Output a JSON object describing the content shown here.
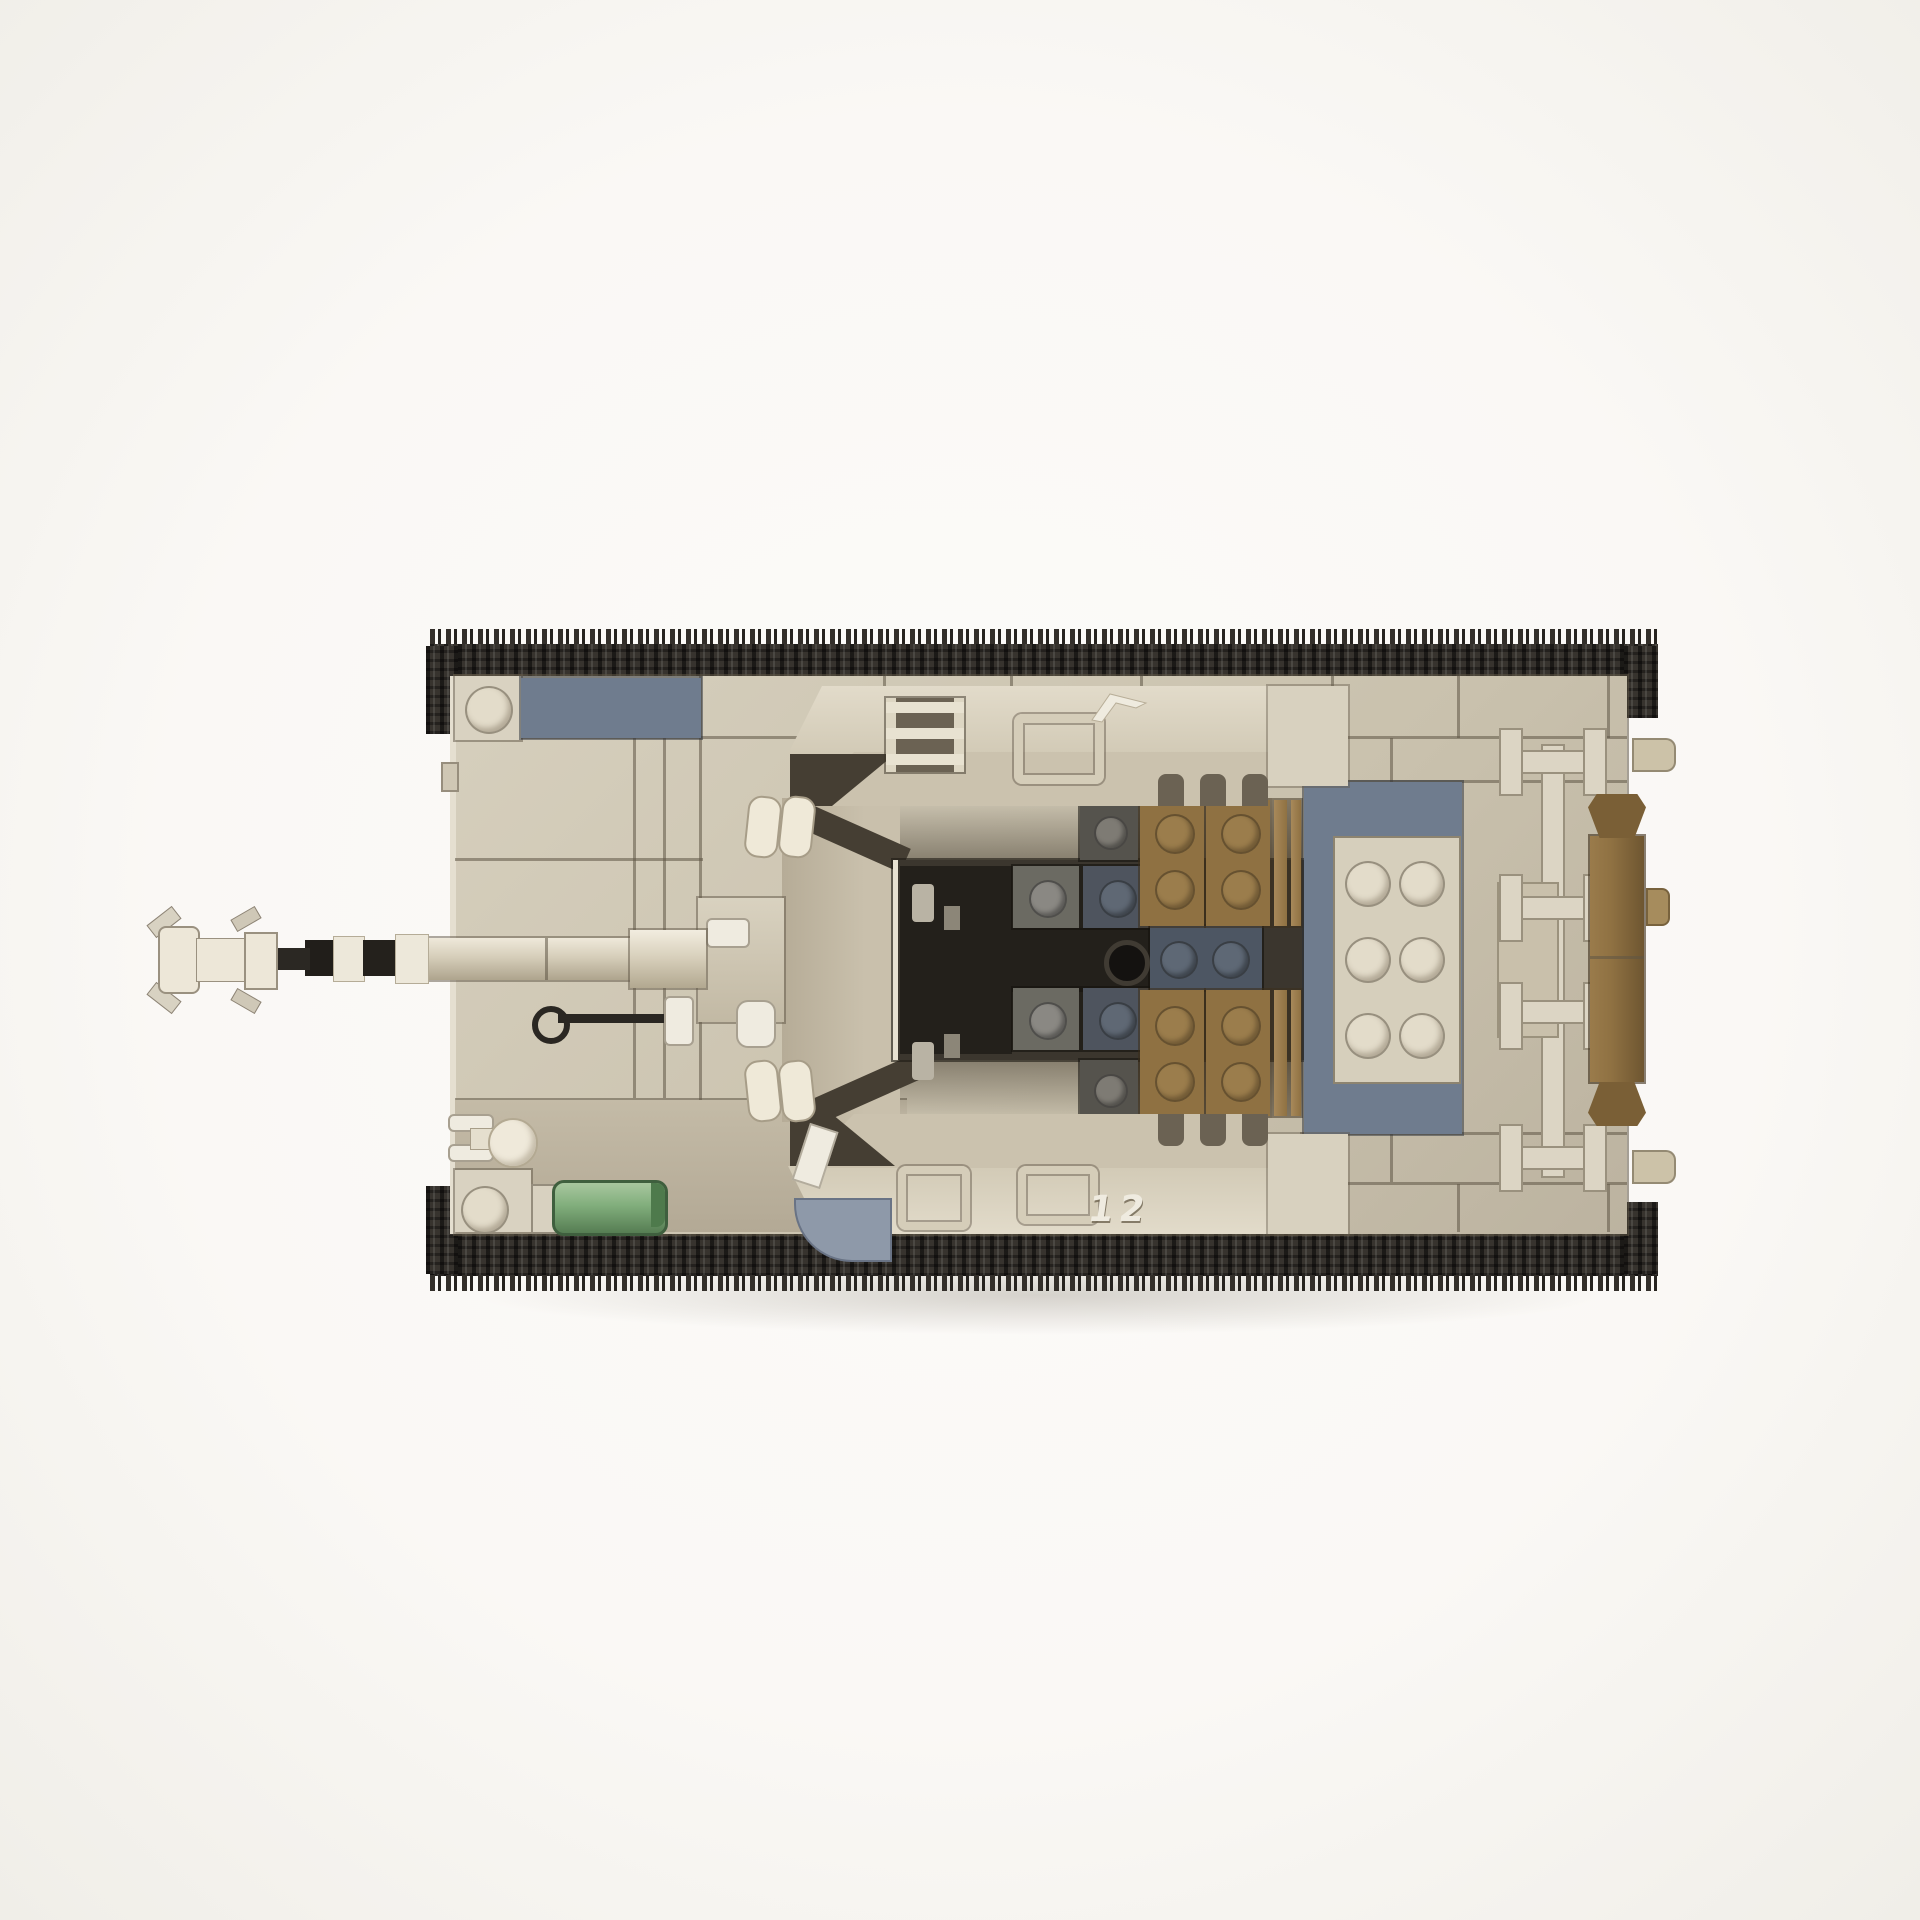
{
  "scene": {
    "subject": "top-down render of a brick-built military tank model"
  },
  "markings": {
    "hull_number": "12"
  },
  "colors": {
    "bg": "#FAF8F5",
    "hull": "#CEC6B3",
    "hull_light": "#D9D2C1",
    "hull_dark": "#B3A995",
    "hull_shadow": "#6B6253",
    "blue_gray": "#6F7C8E",
    "blue_gray_light": "#8E99A9",
    "brown": "#8F7142",
    "brown_dark": "#7A5F36",
    "tan_stud_plate": "#D6CFBC",
    "cream_stud": "#E3DCCA",
    "dark_plate": "#6B6A62",
    "dark_blue_plate": "#4E545E",
    "black_pit": "#23201B",
    "pit_floor": "#3B362E",
    "hole_black": "#141210",
    "track": "#37332E",
    "white_piece": "#EFEBE0",
    "green": "#81AE7C",
    "green_dark": "#567D53",
    "antenna": "#2A2722"
  }
}
